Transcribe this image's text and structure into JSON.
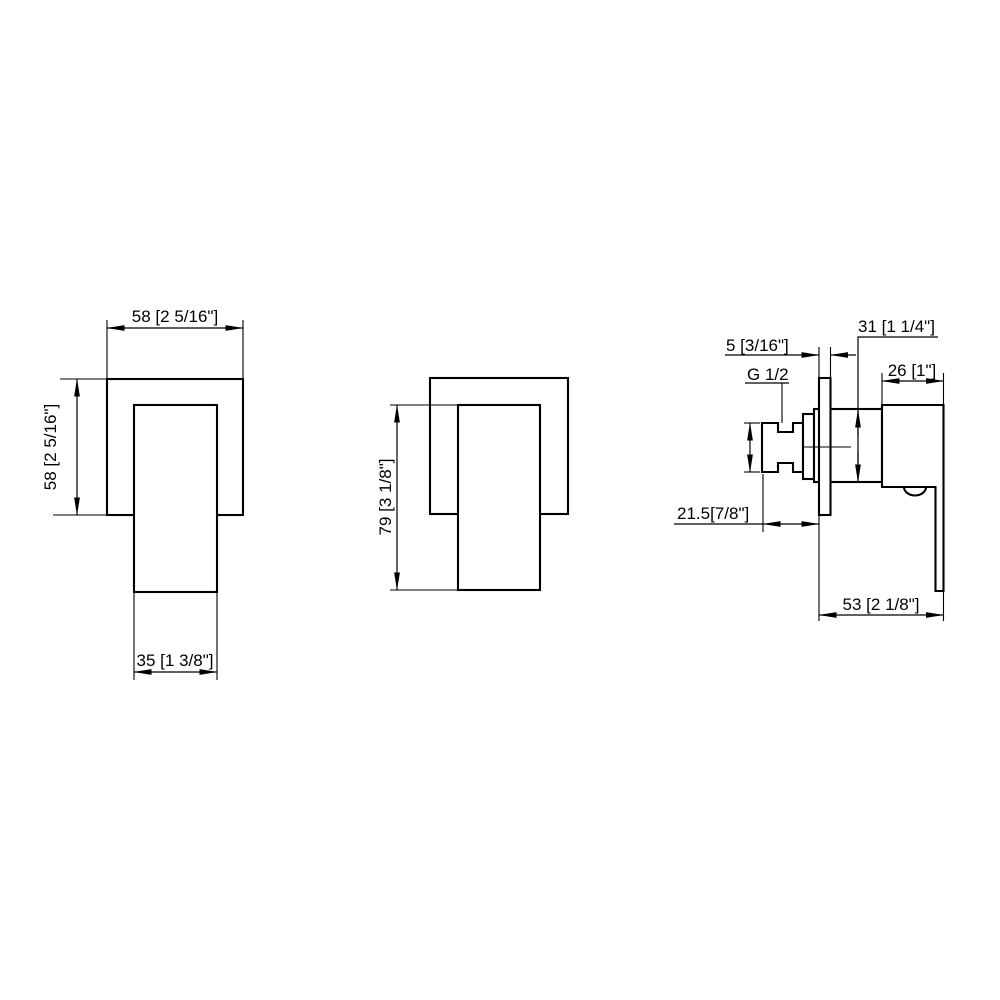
{
  "page": {
    "background_color": "#ffffff",
    "line_color": "#000000"
  },
  "views": {
    "front": {
      "plate_width_label": "58 [2 5/16\"]",
      "plate_height_label": "58 [2 5/16\"]",
      "handle_width_label": "35 [1 3/8\"]"
    },
    "front_secondary": {
      "handle_height_label": "79 [3 1/8\"]"
    },
    "side": {
      "plate_thickness_label": "5 [3/16\"]",
      "thread_size_label": "G 1/2",
      "body_height_label": "31 [1 1/4\"]",
      "handle_base_depth_label": "26 [1\"]",
      "inlet_to_wall_label": "21.5[7/8\"]",
      "overall_depth_label": "53 [2 1/8\"]"
    }
  }
}
